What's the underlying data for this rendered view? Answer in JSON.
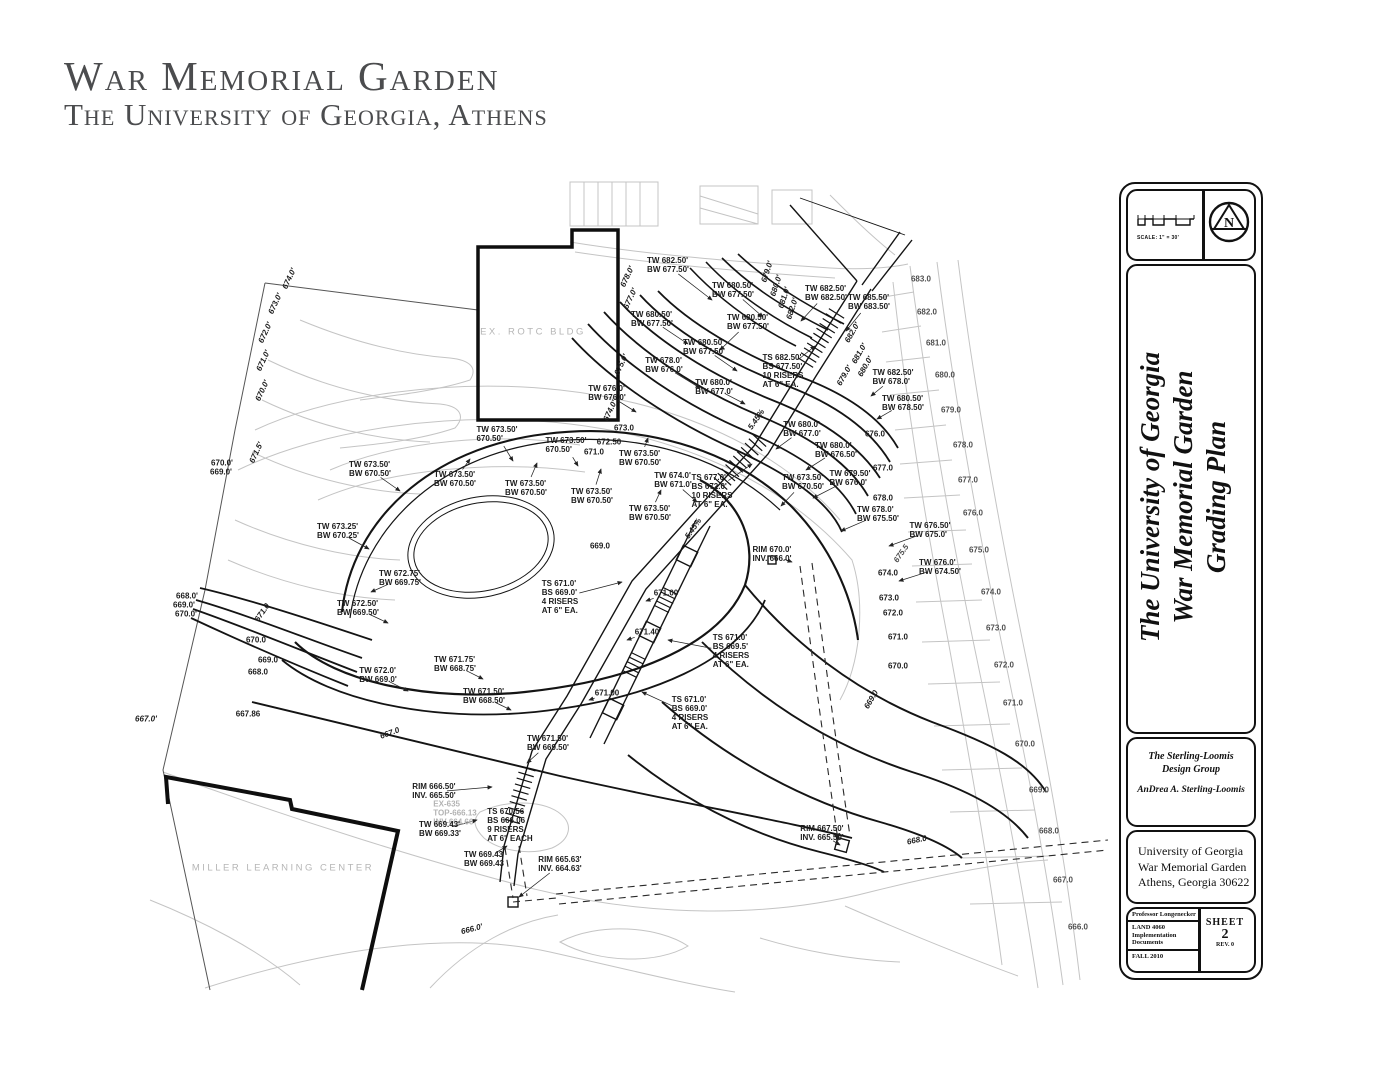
{
  "header": {
    "title": "War Memorial Garden",
    "subtitle": "The University of Georgia, Athens"
  },
  "titleblock": {
    "scale_label": "SCALE: 1\" = 30'",
    "north_letter": "N",
    "project_title_lines": [
      "The University of Georgia",
      "War Memorial Garden",
      "Grading Plan"
    ],
    "firm": {
      "name_line1": "The Sterling-Loomis",
      "name_line2": "Design Group",
      "author": "AnDrea A. Sterling-Loomis"
    },
    "address": {
      "line1": "University of Georgia",
      "line2": "War Memorial Garden",
      "line3": "Athens, Georgia  30622"
    },
    "project_info": {
      "professor": "Professor Longenecker",
      "course": "LAND 4060",
      "documents": "Implementation Documents",
      "term": "FALL 2010"
    },
    "sheet": {
      "label": "SHEET",
      "number": "2",
      "rev": "REV. 0"
    }
  },
  "colors": {
    "ink": "#1a1a1a",
    "light_contour": "#c4c4c4",
    "medium_label": "#4f4f4f",
    "header_gray": "#4b4c4e"
  },
  "drawing": {
    "annotations": [
      {
        "x": 668,
        "y": 266,
        "t": [
          "TW 682.50'",
          "BW 677.50'"
        ],
        "ldr": [
          712,
          300
        ]
      },
      {
        "x": 733,
        "y": 291,
        "t": [
          "TW 680.50'",
          "BW 677.50'"
        ],
        "ldr": [
          763,
          317
        ]
      },
      {
        "x": 826,
        "y": 294,
        "t": [
          "TW 682.50'",
          "BW 682.50'"
        ],
        "ldr": [
          801,
          321
        ]
      },
      {
        "x": 869,
        "y": 303,
        "t": [
          "TW 685.50'",
          "BW 683.50'"
        ],
        "ldr": [
          846,
          331
        ]
      },
      {
        "x": 652,
        "y": 320,
        "t": [
          "TW 680.50'",
          "BW 677.50'"
        ],
        "ldr": [
          688,
          344
        ]
      },
      {
        "x": 748,
        "y": 323,
        "t": [
          "TW 680.50'",
          "BW 677.50'"
        ],
        "ldr": [
          720,
          350
        ]
      },
      {
        "x": 704,
        "y": 348,
        "t": [
          "TW 680.50'",
          "BW 677.50'"
        ],
        "ldr": [
          737,
          371
        ]
      },
      {
        "x": 664,
        "y": 366,
        "t": [
          "TW 678.0'",
          "BW 676.0'"
        ],
        "ldr": [
          700,
          388
        ]
      },
      {
        "x": 714,
        "y": 388,
        "t": [
          "TW 680.0'",
          "BW 677.0'"
        ],
        "ldr": [
          745,
          404
        ]
      },
      {
        "x": 783,
        "y": 372,
        "t": [
          "TS 682.50'",
          "BS 677.50'",
          "10 RISERS",
          "AT 6\" EA."
        ],
        "ldr": [
          815,
          346
        ]
      },
      {
        "x": 893,
        "y": 378,
        "t": [
          "TW 682.50'",
          "BW 678.0'"
        ],
        "ldr": [
          871,
          396
        ]
      },
      {
        "x": 903,
        "y": 404,
        "t": [
          "TW 680.50'",
          "BW 678.50'"
        ],
        "ldr": [
          877,
          419
        ]
      },
      {
        "x": 607,
        "y": 394,
        "t": [
          "TW 676.0'",
          "BW 676.0'"
        ],
        "ldr": [
          636,
          412
        ]
      },
      {
        "x": 768,
        "y": 272,
        "t": [
          "679.0'"
        ],
        "rot": -72,
        "i": 1
      },
      {
        "x": 777,
        "y": 286,
        "t": [
          "680.0'"
        ],
        "rot": -72,
        "i": 1
      },
      {
        "x": 785,
        "y": 298,
        "t": [
          "681.0'"
        ],
        "rot": -72,
        "i": 1
      },
      {
        "x": 793,
        "y": 309,
        "t": [
          "682.0'"
        ],
        "rot": -72,
        "i": 1
      },
      {
        "x": 853,
        "y": 333,
        "t": [
          "682.0'"
        ],
        "rot": -60,
        "i": 1
      },
      {
        "x": 860,
        "y": 354,
        "t": [
          "681.0'"
        ],
        "rot": -60,
        "i": 1
      },
      {
        "x": 866,
        "y": 367,
        "t": [
          "680.0'"
        ],
        "rot": -60,
        "i": 1
      },
      {
        "x": 845,
        "y": 376,
        "t": [
          "679.0'"
        ],
        "rot": -60,
        "i": 1
      },
      {
        "x": 628,
        "y": 277,
        "t": [
          "678.0'"
        ],
        "rot": -65,
        "i": 1
      },
      {
        "x": 631,
        "y": 299,
        "t": [
          "677.0'"
        ],
        "rot": -65,
        "i": 1
      },
      {
        "x": 622,
        "y": 365,
        "t": [
          "675.0'"
        ],
        "rot": -65,
        "i": 1
      },
      {
        "x": 611,
        "y": 411,
        "t": [
          "674.0'"
        ],
        "rot": -65,
        "i": 1
      },
      {
        "x": 757,
        "y": 420,
        "t": [
          "5.45%"
        ],
        "rot": -55,
        "i": 1
      },
      {
        "x": 694,
        "y": 529,
        "t": [
          "5.45%"
        ],
        "rot": -55,
        "i": 1
      },
      {
        "x": 497,
        "y": 435,
        "t": [
          "TW 673.50'",
          "670.50'"
        ],
        "ldr": [
          513,
          461
        ]
      },
      {
        "x": 566,
        "y": 446,
        "t": [
          "TW 673.50'",
          "670.50'"
        ],
        "ldr": [
          578,
          466
        ]
      },
      {
        "x": 640,
        "y": 459,
        "t": [
          "TW 673.50'",
          "BW 670.50'"
        ],
        "ldr": [
          648,
          438
        ]
      },
      {
        "x": 370,
        "y": 470,
        "t": [
          "TW 673.50'",
          "BW 670.50'"
        ],
        "ldr": [
          400,
          491
        ]
      },
      {
        "x": 455,
        "y": 480,
        "t": [
          "TW 673.50'",
          "BW 670.50'"
        ],
        "ldr": [
          470,
          459
        ]
      },
      {
        "x": 526,
        "y": 489,
        "t": [
          "TW 673.50'",
          "BW 670.50'"
        ],
        "ldr": [
          537,
          463
        ]
      },
      {
        "x": 592,
        "y": 497,
        "t": [
          "TW 673.50'",
          "BW 670.50'"
        ],
        "ldr": [
          601,
          469
        ]
      },
      {
        "x": 650,
        "y": 514,
        "t": [
          "TW 673.50'",
          "BW 670.50'"
        ],
        "ldr": [
          661,
          490
        ]
      },
      {
        "x": 673,
        "y": 481,
        "t": [
          "TW 674.0'",
          "BW 671.0'"
        ],
        "ldr": [
          697,
          502
        ]
      },
      {
        "x": 803,
        "y": 483,
        "t": [
          "TW 673.50'",
          "BW 670.50'"
        ],
        "ldr": [
          781,
          506
        ]
      },
      {
        "x": 338,
        "y": 532,
        "t": [
          "TW 673.25'",
          "BW 670.25'"
        ],
        "ldr": [
          369,
          549
        ]
      },
      {
        "x": 400,
        "y": 579,
        "t": [
          "TW 672.75'",
          "BW 669.75'"
        ],
        "ldr": [
          371,
          592
        ]
      },
      {
        "x": 358,
        "y": 609,
        "t": [
          "TW 672.50'",
          "BW 669.50'"
        ],
        "ldr": [
          388,
          623
        ]
      },
      {
        "x": 378,
        "y": 676,
        "t": [
          "TW 672.0'",
          "BW 669.0'"
        ],
        "ldr": [
          408,
          691
        ]
      },
      {
        "x": 455,
        "y": 665,
        "t": [
          "TW 671.75'",
          "BW 668.75'"
        ],
        "ldr": [
          483,
          679
        ]
      },
      {
        "x": 484,
        "y": 697,
        "t": [
          "TW 671.50'",
          "BW 668.50'"
        ],
        "ldr": [
          511,
          710
        ]
      },
      {
        "x": 548,
        "y": 744,
        "t": [
          "TW 671.50'",
          "BW 669.50'"
        ],
        "ldr": [
          527,
          763
        ]
      },
      {
        "x": 624,
        "y": 429,
        "t": [
          "673.0"
        ]
      },
      {
        "x": 609,
        "y": 443,
        "t": [
          "672.50"
        ]
      },
      {
        "x": 594,
        "y": 453,
        "t": [
          "671.0"
        ]
      },
      {
        "x": 600,
        "y": 547,
        "t": [
          "669.0"
        ]
      },
      {
        "x": 666,
        "y": 594,
        "t": [
          "671.00"
        ],
        "ldr": [
          646,
          601
        ]
      },
      {
        "x": 647,
        "y": 633,
        "t": [
          "671.40"
        ],
        "ldr": [
          627,
          640
        ]
      },
      {
        "x": 607,
        "y": 694,
        "t": [
          "671.00"
        ],
        "ldr": [
          589,
          700
        ]
      },
      {
        "x": 560,
        "y": 598,
        "t": [
          "TS 671.0'",
          "BS 669.0'",
          "4 RISERS",
          "AT 6\" EA."
        ],
        "ldr": [
          622,
          582
        ]
      },
      {
        "x": 731,
        "y": 652,
        "t": [
          "TS 671.0'",
          "BS 669.5'",
          "4 RISERS",
          "AT 6\" EA."
        ],
        "ldr": [
          668,
          640
        ]
      },
      {
        "x": 690,
        "y": 714,
        "t": [
          "TS 671.0'",
          "BS 669.0'",
          "4 RISERS",
          "AT 6\" EA."
        ],
        "ldr": [
          642,
          692
        ]
      },
      {
        "x": 802,
        "y": 430,
        "t": [
          "TW 680.0'",
          "BW 677.0'"
        ],
        "ldr": [
          776,
          449
        ]
      },
      {
        "x": 836,
        "y": 451,
        "t": [
          "TW 680.0'",
          "BW 676.50'"
        ],
        "ldr": [
          806,
          470
        ]
      },
      {
        "x": 850,
        "y": 479,
        "t": [
          "TW 679.50'",
          "BW 676.0'"
        ],
        "ldr": [
          813,
          498
        ]
      },
      {
        "x": 878,
        "y": 515,
        "t": [
          "TW 678.0'",
          "BW 675.50'"
        ],
        "ldr": [
          841,
          531
        ]
      },
      {
        "x": 930,
        "y": 531,
        "t": [
          "TW 676.50'",
          "BW 675.0'"
        ],
        "ldr": [
          889,
          546
        ]
      },
      {
        "x": 940,
        "y": 568,
        "t": [
          "TW 676.0'",
          "BW 674.50'"
        ],
        "ldr": [
          899,
          581
        ]
      },
      {
        "x": 712,
        "y": 492,
        "t": [
          "TS 677.0'",
          "BS 672.0'",
          "10 RISERS",
          "AT 6\" EA."
        ],
        "ldr": [
          752,
          464
        ]
      },
      {
        "x": 772,
        "y": 555,
        "t": [
          "RIM 670.0'",
          "INV. 666.0'"
        ],
        "ldr": [
          792,
          562
        ]
      },
      {
        "x": 875,
        "y": 435,
        "t": [
          "676.0"
        ]
      },
      {
        "x": 883,
        "y": 469,
        "t": [
          "677.0"
        ]
      },
      {
        "x": 883,
        "y": 499,
        "t": [
          "678.0"
        ]
      },
      {
        "x": 902,
        "y": 554,
        "t": [
          "675.5"
        ],
        "rot": -55,
        "i": 1,
        "k": "m"
      },
      {
        "x": 888,
        "y": 574,
        "t": [
          "674.0"
        ]
      },
      {
        "x": 889,
        "y": 599,
        "t": [
          "673.0"
        ]
      },
      {
        "x": 893,
        "y": 614,
        "t": [
          "672.0"
        ]
      },
      {
        "x": 898,
        "y": 638,
        "t": [
          "671.0"
        ]
      },
      {
        "x": 898,
        "y": 667,
        "t": [
          "670.0"
        ]
      },
      {
        "x": 872,
        "y": 700,
        "t": [
          "669.0"
        ],
        "rot": -60,
        "i": 1
      },
      {
        "x": 917,
        "y": 841,
        "t": [
          "668.0"
        ],
        "rot": -12,
        "i": 1
      },
      {
        "x": 921,
        "y": 280,
        "t": [
          "683.0"
        ],
        "k": "m"
      },
      {
        "x": 927,
        "y": 313,
        "t": [
          "682.0"
        ],
        "k": "m"
      },
      {
        "x": 936,
        "y": 344,
        "t": [
          "681.0"
        ],
        "k": "m"
      },
      {
        "x": 945,
        "y": 376,
        "t": [
          "680.0"
        ],
        "k": "m"
      },
      {
        "x": 951,
        "y": 411,
        "t": [
          "679.0"
        ],
        "k": "m"
      },
      {
        "x": 963,
        "y": 446,
        "t": [
          "678.0"
        ],
        "k": "m"
      },
      {
        "x": 968,
        "y": 481,
        "t": [
          "677.0"
        ],
        "k": "m"
      },
      {
        "x": 973,
        "y": 514,
        "t": [
          "676.0"
        ],
        "k": "m"
      },
      {
        "x": 979,
        "y": 551,
        "t": [
          "675.0"
        ],
        "k": "m"
      },
      {
        "x": 991,
        "y": 593,
        "t": [
          "674.0"
        ],
        "k": "m"
      },
      {
        "x": 996,
        "y": 629,
        "t": [
          "673.0"
        ],
        "k": "m"
      },
      {
        "x": 1004,
        "y": 666,
        "t": [
          "672.0"
        ],
        "k": "m"
      },
      {
        "x": 1013,
        "y": 704,
        "t": [
          "671.0"
        ],
        "k": "m"
      },
      {
        "x": 1025,
        "y": 745,
        "t": [
          "670.0"
        ],
        "k": "m"
      },
      {
        "x": 1039,
        "y": 791,
        "t": [
          "669.0"
        ],
        "k": "m"
      },
      {
        "x": 1049,
        "y": 832,
        "t": [
          "668.0"
        ],
        "k": "m"
      },
      {
        "x": 1063,
        "y": 881,
        "t": [
          "667.0"
        ],
        "k": "m"
      },
      {
        "x": 1078,
        "y": 928,
        "t": [
          "666.0"
        ],
        "k": "m"
      },
      {
        "x": 290,
        "y": 279,
        "t": [
          "674.0'"
        ],
        "rot": -65,
        "i": 1
      },
      {
        "x": 276,
        "y": 304,
        "t": [
          "673.0'"
        ],
        "rot": -65,
        "i": 1
      },
      {
        "x": 266,
        "y": 333,
        "t": [
          "672.0'"
        ],
        "rot": -65,
        "i": 1
      },
      {
        "x": 264,
        "y": 361,
        "t": [
          "671.0'"
        ],
        "rot": -65,
        "i": 1
      },
      {
        "x": 263,
        "y": 391,
        "t": [
          "670.0'"
        ],
        "rot": -65,
        "i": 1
      },
      {
        "x": 257,
        "y": 453,
        "t": [
          "671.5'"
        ],
        "rot": -65,
        "i": 1
      },
      {
        "x": 222,
        "y": 464,
        "t": [
          "670.0'"
        ]
      },
      {
        "x": 221,
        "y": 473,
        "t": [
          "669.0'"
        ]
      },
      {
        "x": 187,
        "y": 597,
        "t": [
          "668.0'"
        ]
      },
      {
        "x": 184,
        "y": 606,
        "t": [
          "669.0'"
        ]
      },
      {
        "x": 186,
        "y": 615,
        "t": [
          "670.0'"
        ]
      },
      {
        "x": 146,
        "y": 720,
        "t": [
          "667.0'"
        ],
        "i": 1
      },
      {
        "x": 248,
        "y": 715,
        "t": [
          "667.86"
        ]
      },
      {
        "x": 390,
        "y": 734,
        "t": [
          "667.0"
        ],
        "rot": -20,
        "i": 1
      },
      {
        "x": 263,
        "y": 613,
        "t": [
          "671.0"
        ],
        "rot": -55,
        "i": 1
      },
      {
        "x": 256,
        "y": 641,
        "t": [
          "670.0"
        ]
      },
      {
        "x": 268,
        "y": 661,
        "t": [
          "669.0"
        ]
      },
      {
        "x": 258,
        "y": 673,
        "t": [
          "668.0"
        ]
      },
      {
        "x": 434,
        "y": 792,
        "t": [
          "RIM 666.50'",
          "INV. 665.50'"
        ],
        "ldr": [
          492,
          787
        ]
      },
      {
        "x": 455,
        "y": 814,
        "t": [
          "EX-635",
          "TOP-666.13",
          "INV-664.66"
        ],
        "k": "g"
      },
      {
        "x": 440,
        "y": 830,
        "t": [
          "TW 669.43'",
          "BW 669.33'"
        ],
        "ldr": [
          477,
          820
        ]
      },
      {
        "x": 510,
        "y": 826,
        "t": [
          "TS 670.56",
          "BS 666.06",
          "9 RISERS",
          "AT 6\" EACH"
        ]
      },
      {
        "x": 484,
        "y": 860,
        "t": [
          "TW 669.43",
          "BW 669.43"
        ],
        "ldr": [
          507,
          846
        ]
      },
      {
        "x": 560,
        "y": 865,
        "t": [
          "RIM 665.63'",
          "INV. 664.63'"
        ],
        "ldr": [
          519,
          897
        ]
      },
      {
        "x": 822,
        "y": 834,
        "t": [
          "RIM 667.50'",
          "INV. 665.50'"
        ],
        "ldr": [
          840,
          845
        ]
      },
      {
        "x": 472,
        "y": 930,
        "t": [
          "666.0'"
        ],
        "rot": -15,
        "i": 1
      },
      {
        "x": 533,
        "y": 333,
        "t": [
          "EX. ROTC BLDG"
        ],
        "b": 1
      },
      {
        "x": 283,
        "y": 869,
        "t": [
          "MILLER LEARNING CENTER"
        ],
        "b": 1
      }
    ]
  }
}
